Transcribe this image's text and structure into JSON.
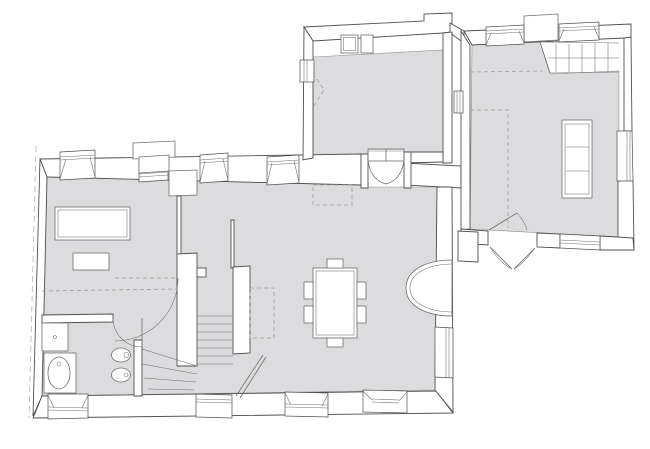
{
  "plan": {
    "background": "#ffffff",
    "floor_fill": "#dcdcde",
    "wall_fill": "#ffffff",
    "wall_stroke": "#4f4f4f",
    "floor_stroke": "#8f8f8f",
    "fixture_stroke": "#6e6e6e",
    "dash_stroke": "#9f9f9f",
    "boundary_stroke": "#bdbdbd"
  },
  "symbols": [
    "property-line",
    "kitchen-counter",
    "sink-unit",
    "appliance-unit",
    "double-door",
    "french-door",
    "door-swing",
    "window",
    "chimney",
    "fireplace",
    "staircase",
    "winder-staircase",
    "upper-staircase",
    "sofa",
    "dining-table",
    "dining-chair",
    "living-table",
    "side-table",
    "bathtub",
    "washbasin",
    "toilet",
    "bidet",
    "wall-alcove",
    "loft-dashed-outline",
    "ceiling-opening-dashed"
  ]
}
